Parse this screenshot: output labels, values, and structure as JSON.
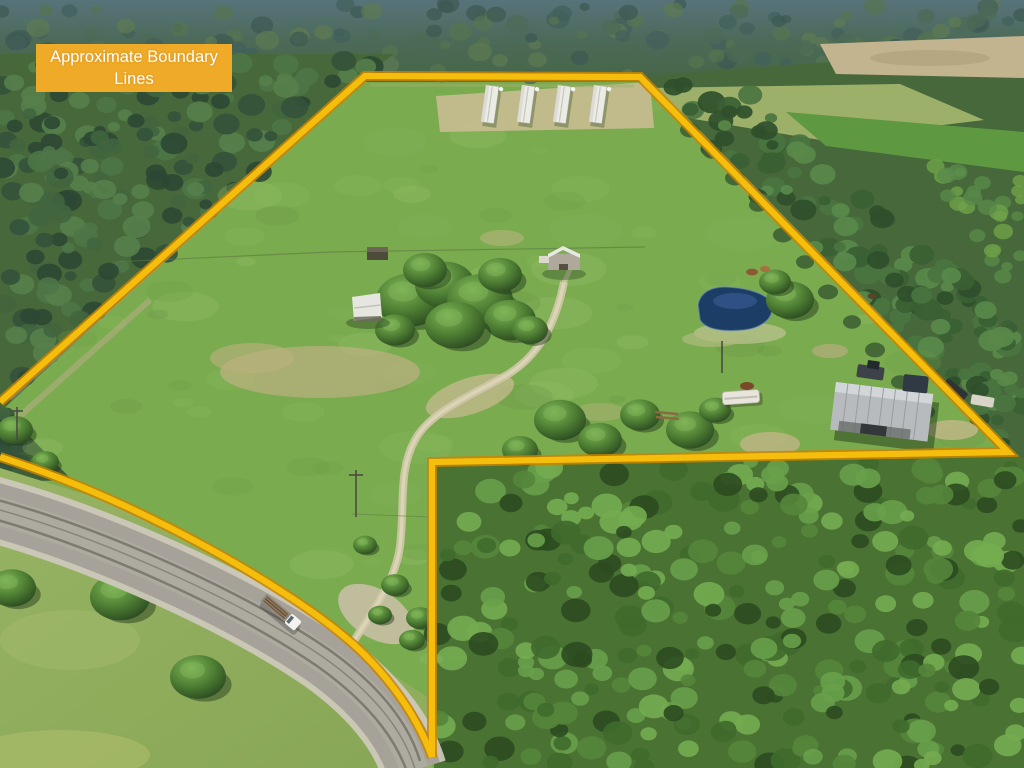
{
  "label": {
    "text": "Approximate Boundary Lines"
  },
  "colors": {
    "boundary_yellow": "#F6BE0C",
    "boundary_edge": "#C98400",
    "label_bg": "#EFAA28",
    "label_text": "#FFFFFF",
    "pasture_green": "#7BAB4F",
    "forest_green": "#47683A",
    "forest_top_haze": "#537074",
    "road_gray": "#A6A299",
    "road_shoulder": "#CDC8BB",
    "pond_blue": "#1C3E66",
    "dirt_tan": "#C6BA8E"
  },
  "boundary": {
    "path": "M 0 402 L 365 76 L 640 77 L 1008 452 L 432 462 L 432 757 C 415 710 380 665 340 633 C 290 592 150 505 0 457",
    "vertices": [
      [
        0,
        402
      ],
      [
        365,
        76
      ],
      [
        640,
        77
      ],
      [
        1008,
        452
      ],
      [
        432,
        462
      ],
      [
        432,
        757
      ]
    ]
  },
  "road": {
    "path": "M -12 508 C 100 538 240 602 322 658 C 370 692 402 730 414 770"
  },
  "features": {
    "poultry_houses": 4,
    "farmhouse": 1,
    "center_barn": 1,
    "equipment_shed": 1,
    "pond": 1,
    "rv_trailer": 1,
    "log_truck_on_road": 1,
    "utility_poles": 3
  }
}
